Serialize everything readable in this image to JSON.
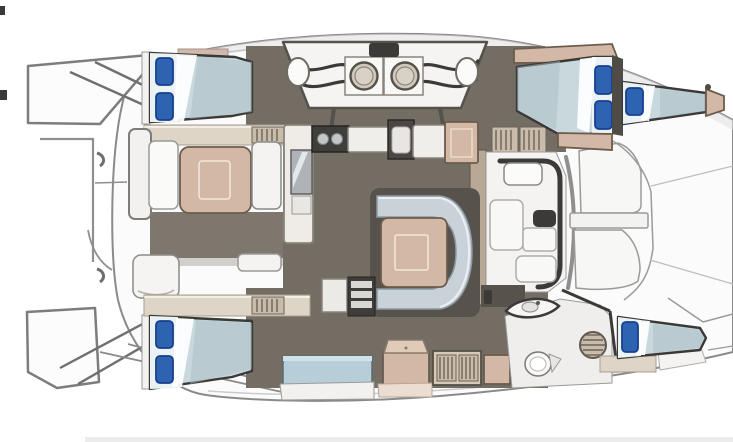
{
  "title": "Catamaran yacht interior floor plan, top view",
  "colors": {
    "hull_fill": "#fbfbfb",
    "hull_line": "#8a8a8a",
    "floor_dark": "#746d64",
    "wall_dark": "#4f4b46",
    "shadow_dark": "#57524c",
    "tan": "#d3b9a5",
    "tan_border": "#6b5c4d",
    "shelf_beige": "#ded5c6",
    "louver": "#c9bcaa",
    "louver_slat": "#6b6258",
    "mattress": "#c9d8dd",
    "mattress_head": "#eaf2f4",
    "mattress_shade": "#a9bec6",
    "pillow_blue": "#2d63b0",
    "pillow_border": "#17408f",
    "settee_gray": "#c9d2d9",
    "bench_blue": "#b7cdd8",
    "appliance_dark": "#3c3a38",
    "white_furniture": "#f4f3f1",
    "outline_dark": "#3b3936"
  },
  "areas": [
    {
      "id": "hull",
      "label": "Yacht hull and deck outline"
    },
    {
      "id": "forward-seating",
      "label": "Curved seating area with two round basins and hatch"
    },
    {
      "id": "top-left-cabin",
      "label": "Double berth cabin, upper left, two blue pillows"
    },
    {
      "id": "cockpit-lounge",
      "label": "Lounge seating with square tan table, left side"
    },
    {
      "id": "galley",
      "label": "Galley with cooktop, sink, counters and refrigerator"
    },
    {
      "id": "salon-dinette",
      "label": "U-shaped settee with tan table, center salon"
    },
    {
      "id": "companionway-lower",
      "label": "Companionway steps and cabinet, lower salon"
    },
    {
      "id": "companionway-upper",
      "label": "Louvered companionway steps, upper side"
    },
    {
      "id": "helm-station",
      "label": "Helm station with seat, lockers and wheel"
    },
    {
      "id": "bow-deck",
      "label": "Bow deck panels and lockers, right side"
    },
    {
      "id": "top-right-cabins",
      "label": "Two tapered berths, upper right, three blue pillows"
    },
    {
      "id": "bottom-left-cabin",
      "label": "Double berth cabin, lower left, two blue pillows"
    },
    {
      "id": "storage-row",
      "label": "Bench seat, console and louvered cabinets, lower center"
    },
    {
      "id": "bathroom",
      "label": "Bathroom with vanity sink, toilet and round louvered hatch"
    },
    {
      "id": "bottom-right-cabin",
      "label": "Single tapered berth, lower right, one blue pillow"
    },
    {
      "id": "transom",
      "label": "Transom platforms, davit and rigging lines, left side"
    }
  ],
  "furniture_counts": {
    "beds": 5,
    "blue_pillows": 8,
    "tables": 2,
    "round_basins": 2,
    "cooktop": 1,
    "galley_sink": 1,
    "refrigerator": 1,
    "vanity_sink": 1,
    "toilet": 1,
    "round_louvered_hatch": 1,
    "companionway_stairs": 2,
    "bench_seats": 4
  }
}
